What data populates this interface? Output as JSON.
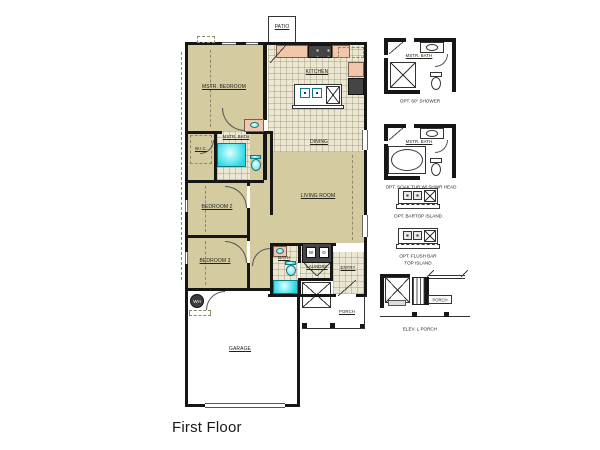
{
  "title": "First Floor",
  "colors": {
    "wall": "#161616",
    "room_tan": "#d5cba1",
    "tile_beige": "#ece7d3",
    "fixture_cyan": "#38d9e3",
    "counter_salmon": "#f2c6ab",
    "appliance_dark": "#454545",
    "background": "#ffffff"
  },
  "plan": {
    "patio": "PATIO",
    "master_bedroom": "MSTR. BEDROOM",
    "kitchen": "KITCHEN",
    "dining": "DINING",
    "living_room": "LIVING ROOM",
    "master_bath": "MSTR. BATH",
    "wic": "W.I.C.",
    "bedroom2": "BEDROOM 2",
    "bedroom3": "BEDROOM 3",
    "bath": "BATH",
    "laundry": "LAUNDRY",
    "washer": "W",
    "dryer": "D",
    "entry": "ENTRY",
    "porch": "PORCH",
    "garage": "GARAGE",
    "water_heater": "WH"
  },
  "options": {
    "shower": {
      "room": "MSTR. BATH",
      "caption": "OPT. 60\" SHOWER"
    },
    "soak_tub": {
      "room": "MSTR. BATH",
      "caption": "OPT. SOAK TUB W/ SHWR HEAD"
    },
    "bartop_island": {
      "caption": "OPT. BARTOP ISLAND"
    },
    "flush_bar_island": {
      "caption_line1": "OPT. FLUSH BAR",
      "caption_line2": "TOP ISLAND"
    },
    "porch_elev": {
      "label": "PORCH",
      "caption": "ELEV. L PORCH"
    }
  }
}
